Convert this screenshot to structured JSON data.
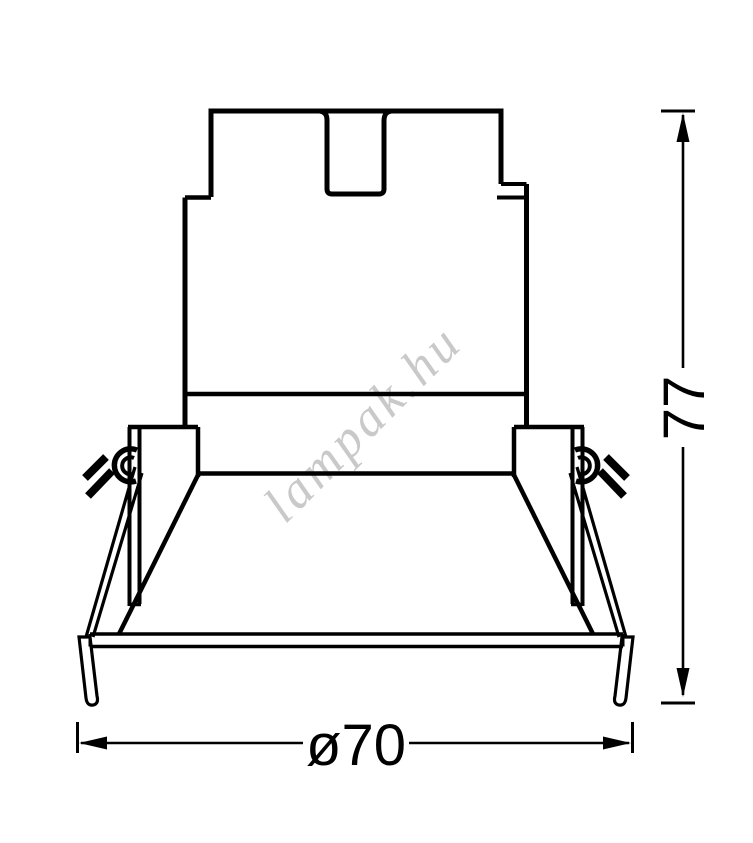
{
  "page": {
    "background_color": "#ffffff",
    "line_color": "#000000"
  },
  "drawing": {
    "kind": "technical dimension drawing of a recessed downlight (side elevation)",
    "watermark": {
      "text": "lampak.hu",
      "color": "#c9c9c9"
    },
    "dimensions": {
      "height": {
        "label": "77"
      },
      "diameter": {
        "label": "ø70"
      }
    }
  }
}
